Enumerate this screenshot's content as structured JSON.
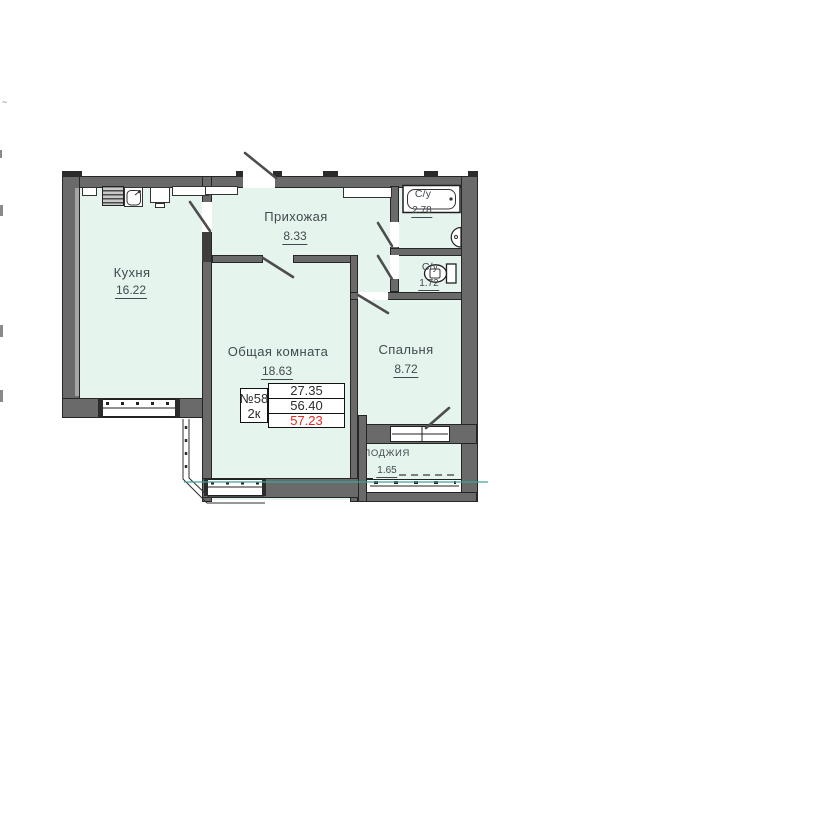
{
  "floorplan": {
    "unit": {
      "number": "№58",
      "type": "2к",
      "areas": {
        "living": "27.35",
        "total": "56.40",
        "with_balcony": "57.23"
      }
    },
    "rooms": [
      {
        "label": "Кухня",
        "area": "16.22"
      },
      {
        "label": "Прихожая",
        "area": "8.33"
      },
      {
        "label": "С/у",
        "area": "2.78"
      },
      {
        "label": "С/у",
        "area": "1.72"
      },
      {
        "label": "Общая комната",
        "area": "18.63"
      },
      {
        "label": "Спальня",
        "area": "8.72"
      },
      {
        "label": "ЛОДЖИЯ",
        "area": "1.65"
      }
    ],
    "icons": [
      "stove-icon",
      "kitchen-sink-icon",
      "bathtub-icon",
      "washbasin-icon",
      "toilet-icon",
      "door-swing-icon",
      "window-icon"
    ],
    "colors": {
      "floor_fill": "#e6f4ee",
      "wall": "#6a6a6a",
      "outline": "#262626",
      "highlight_red": "#e52b20",
      "utility_line_teal": "#3fa49e",
      "text": "#414a4e"
    },
    "edge_artifacts": {
      "tick": "~"
    }
  }
}
